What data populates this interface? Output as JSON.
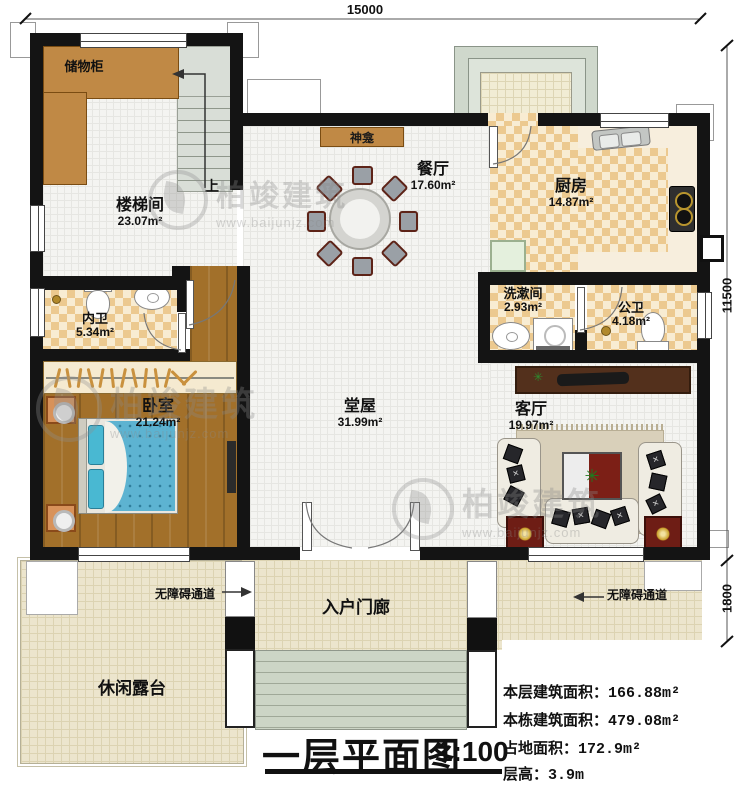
{
  "title_block": {
    "title": "一层平面图",
    "scale": "1:100"
  },
  "dimensions": {
    "top": "15000",
    "right": "11500",
    "right_lower": "1800"
  },
  "rooms": {
    "storage": {
      "name": "储物柜"
    },
    "stairwell": {
      "name": "楼梯间",
      "area": "23.07m²"
    },
    "shrine": {
      "name": "神龛"
    },
    "dining": {
      "name": "餐厅",
      "area": "17.60m²"
    },
    "kitchen": {
      "name": "厨房",
      "area": "14.87m²"
    },
    "washroom": {
      "name": "洗漱间",
      "area": "2.93m²"
    },
    "public_bath": {
      "name": "公卫",
      "area": "4.18m²"
    },
    "ensuite_bath": {
      "name": "内卫",
      "area": "5.34m²"
    },
    "bedroom": {
      "name": "卧室",
      "area": "21.24m²"
    },
    "hall": {
      "name": "堂屋",
      "area": "31.99m²"
    },
    "living": {
      "name": "客厅",
      "area": "19.97m²"
    },
    "porch": {
      "name": "入户门廊"
    },
    "terrace": {
      "name": "休闲露台"
    }
  },
  "annotations": {
    "stairs_up": "上",
    "ramp_left": "无障碍通道",
    "ramp_right": "无障碍通道"
  },
  "stats": {
    "floor_area_label": "本层建筑面积：",
    "floor_area_value": "166.88m²",
    "total_area_label": "本栋建筑面积：",
    "total_area_value": "479.08m²",
    "footprint_label": "占地面积：",
    "footprint_value": "172.9m²",
    "story_height_label": "层高：",
    "story_height_value": "3.9m"
  },
  "watermark": {
    "brand": "柏竣建筑",
    "site": "www.baijunjz.com"
  },
  "colors": {
    "wall": "#141414",
    "cabinet_wood": "#c08945",
    "wood_floor": "#a2702a",
    "checker_tan": "#ecc98f",
    "bed_blue": "#5db3d1",
    "accent_red": "#7c1f16",
    "paving": "#ece5cd"
  }
}
